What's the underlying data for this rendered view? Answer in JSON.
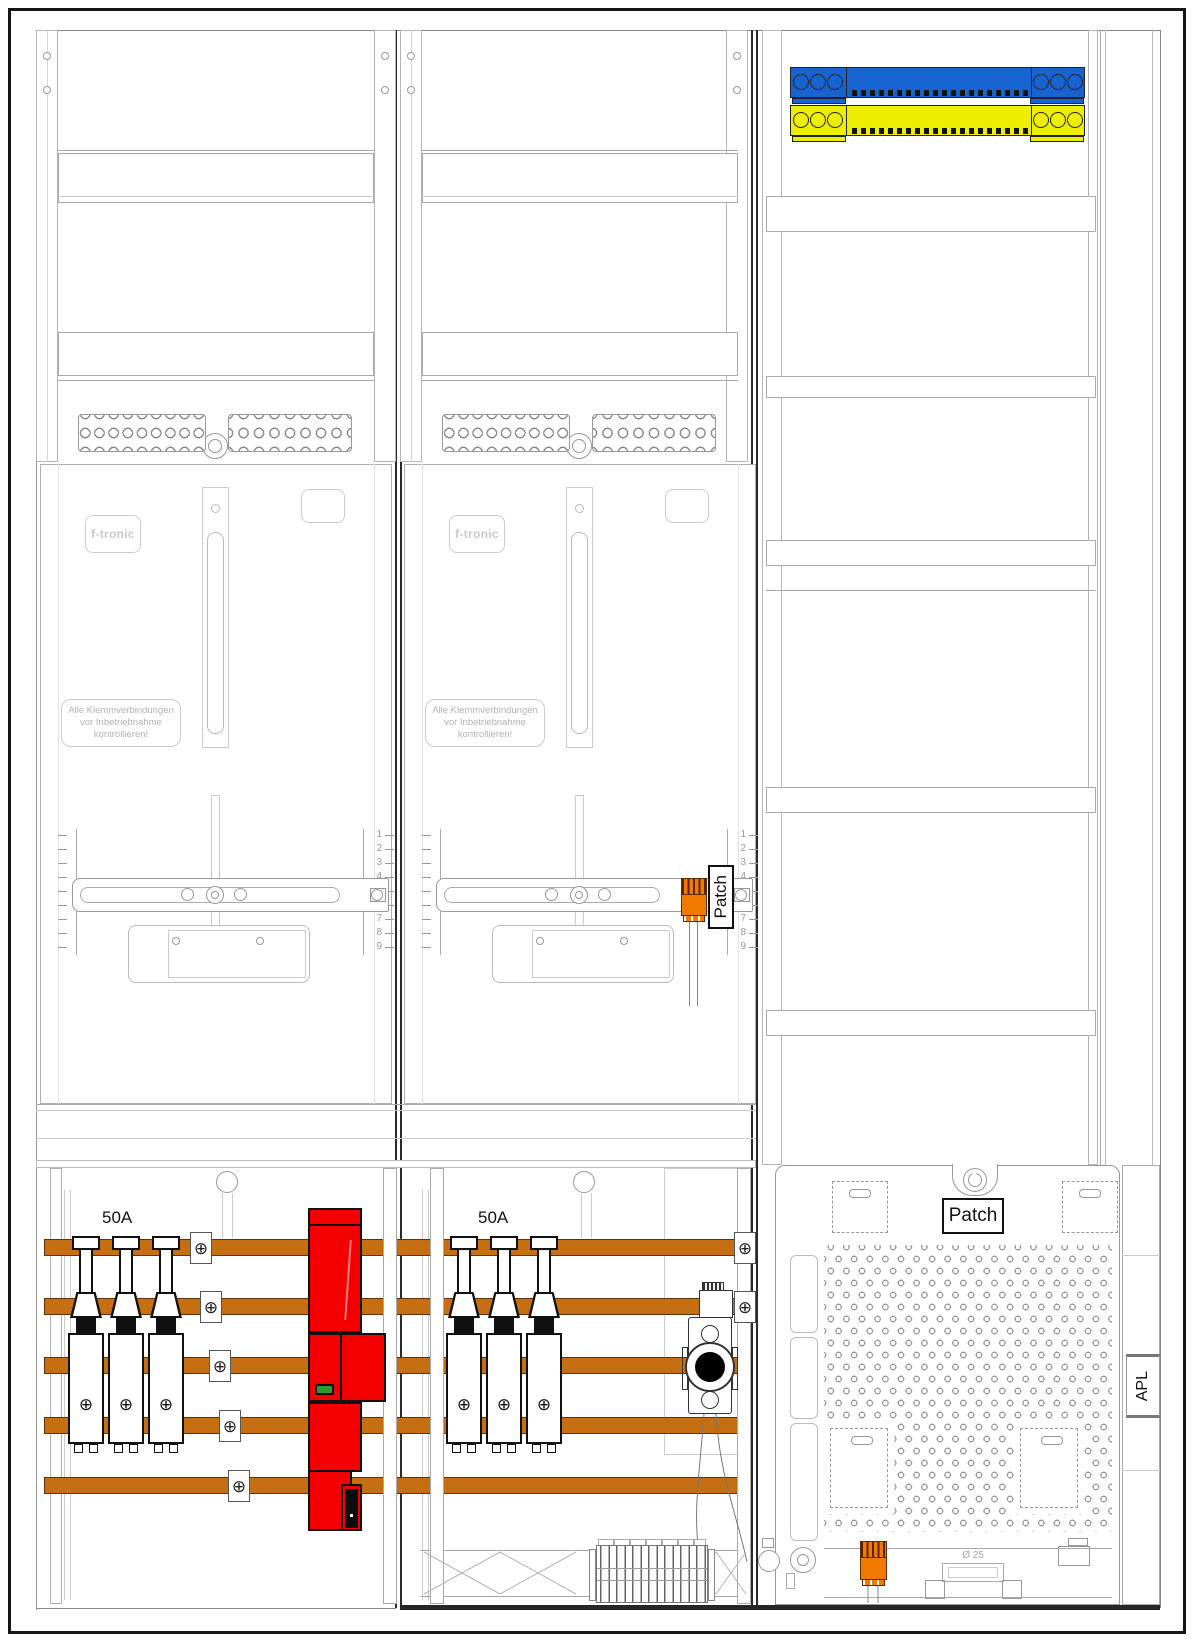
{
  "colors": {
    "busbar_blue": "#1763D2",
    "busbar_yellow": "#EDEE00",
    "busbar_copper": "#C66E12",
    "terminal_orange": "#F27900",
    "component_red": "#F40000",
    "indicator_green": "#2E9B27"
  },
  "scale_numbers": [
    "1",
    "2",
    "3",
    "4",
    "5",
    "6",
    "7",
    "8",
    "9"
  ],
  "meter_panels": [
    {
      "brand": "f-tronic",
      "warning": [
        "Alle Klemmverbindungen",
        "vor Inbetriebnahme",
        "kontrollieren!"
      ]
    },
    {
      "brand": "f-tronic",
      "warning": [
        "Alle Klemmverbindungen",
        "vor Inbetriebnahme",
        "kontrollieren!"
      ],
      "patch_label": "Patch"
    }
  ],
  "lower_section": {
    "breaker_groups": [
      {
        "rating": "50A"
      },
      {
        "rating": "50A"
      }
    ],
    "clamp_symbol": "⊕"
  },
  "right_panel": {
    "patch_label": "Patch",
    "apl_label": "APL",
    "diameter_label": "Ø 25"
  }
}
